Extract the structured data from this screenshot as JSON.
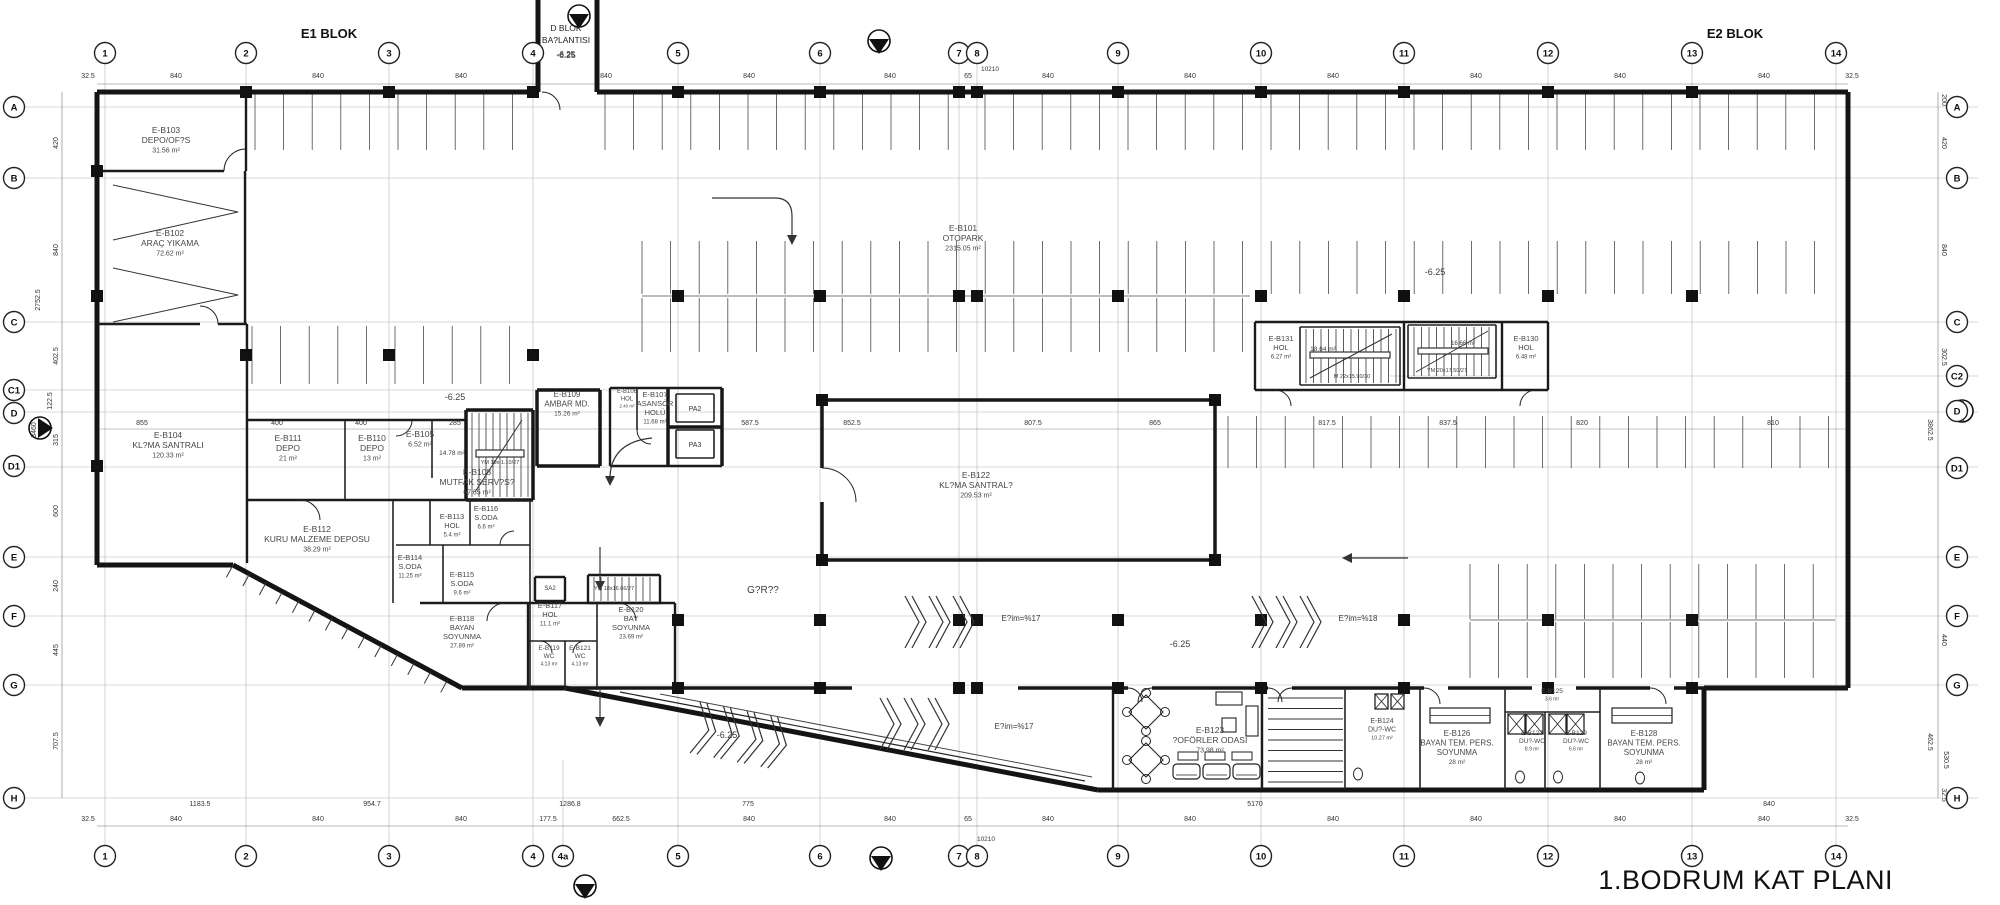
{
  "title": "1.BODRUM KAT PLANI",
  "blocks": {
    "e1": "E1 BLOK",
    "e2": "E2 BLOK",
    "d_line1": "D BLOK",
    "d_line2": "BA?LANTISI",
    "d_level": "-6.25"
  },
  "grid": {
    "cols_top": [
      "1",
      "2",
      "3",
      "4",
      "5",
      "6",
      "7",
      "8",
      "9",
      "10",
      "11",
      "12",
      "13",
      "14"
    ],
    "cols_bottom": [
      "1",
      "2",
      "3",
      "4",
      "4a",
      "5",
      "6",
      "7",
      "8",
      "9",
      "10",
      "11",
      "12",
      "13",
      "14"
    ],
    "rows_left": [
      "A",
      "B",
      "C",
      "C1",
      "D",
      "D1",
      "E",
      "F",
      "G",
      "H"
    ],
    "rows_right": [
      "A",
      "B",
      "C",
      "C2",
      "D",
      "D1",
      "E",
      "F",
      "G",
      "H"
    ]
  },
  "dims": {
    "top": [
      "32.5",
      "840",
      "840",
      "840",
      "840",
      "840",
      "840",
      "65",
      "840",
      "840",
      "840",
      "840",
      "840",
      "840",
      "32.5"
    ],
    "top_total": "10210",
    "bottom_lower": [
      "32.5",
      "840",
      "840",
      "840",
      "177.5",
      "662.5",
      "840",
      "840",
      "65",
      "840",
      "840",
      "840",
      "840",
      "840",
      "840",
      "32.5"
    ],
    "bottom_upper": [
      "1183.5",
      "954.7",
      "1286.8",
      "775",
      "5170",
      "840"
    ],
    "bottom_total": "10210",
    "left": [
      "420",
      "840",
      "2752.5",
      "402.5",
      "122.5",
      "315",
      "3460",
      "600",
      "240",
      "445",
      "707.5"
    ],
    "right": [
      "200",
      "420",
      "840",
      "302.5",
      "3862.5",
      "440",
      "462.5",
      "530.5",
      "32.5"
    ],
    "mid_row": [
      "855",
      "400",
      "400",
      "285",
      "587.5",
      "852.5",
      "807.5",
      "865",
      "817.5",
      "837.5",
      "820",
      "810"
    ]
  },
  "elevators": {
    "pa2": "PA2",
    "pa3": "PA3",
    "sa2": "SA2"
  },
  "rooms": [
    {
      "id": "E-B103",
      "name": "DEPO/OF?S",
      "area": "31.56 m²"
    },
    {
      "id": "E-B102",
      "name": "ARAÇ YIKAMA",
      "area": "72.62 m²"
    },
    {
      "id": "E-B101",
      "name": "OTOPARK",
      "area": "2315.05 m²"
    },
    {
      "id": "E-B104",
      "name": "KL?MA SANTRALI",
      "area": "120.33 m²"
    },
    {
      "id": "E-B111",
      "name": "DEPO",
      "area": "21 m²"
    },
    {
      "id": "E-B110",
      "name": "DEPO",
      "area": "13 m²"
    },
    {
      "id": "E-B105",
      "name": "",
      "area": "6.52 m²"
    },
    {
      "id": "E-B106",
      "name": "HOL",
      "area": "2.40 m²"
    },
    {
      "id": "E-B107",
      "name": "ASANSÖR",
      "name2": "HOLÜ",
      "area": "11.68 m²"
    },
    {
      "id": "E-B109",
      "name": "AMBAR MD.",
      "area": "15.26 m²"
    },
    {
      "id": "E-B108",
      "name": "MUTFAK SERV?S?",
      "area": "67.65 m²"
    },
    {
      "id": "E-B112",
      "name": "KURU MALZEME DEPOSU",
      "area": "38.29 m²"
    },
    {
      "id": "E-B113",
      "name": "HOL",
      "area": "5.4 m²"
    },
    {
      "id": "E-B116",
      "name": "S.ODA",
      "area": "6.6 m²"
    },
    {
      "id": "E-B114",
      "name": "S.ODA",
      "area": "11.25 m²"
    },
    {
      "id": "E-B115",
      "name": "S.ODA",
      "area": "9.6 m²"
    },
    {
      "id": "E-B117",
      "name": "HOL",
      "area": "11.1 m²"
    },
    {
      "id": "E-B118",
      "name": "BAYAN",
      "name2": "SOYUNMA",
      "area": "27.89 m²"
    },
    {
      "id": "E-B119",
      "name": "WC",
      "area": "4.13 m²"
    },
    {
      "id": "E-B121",
      "name": "WC",
      "area": "4.13 m²"
    },
    {
      "id": "E-B120",
      "name": "BAY",
      "name2": "SOYUNMA",
      "area": "23.69 m²"
    },
    {
      "id": "E-B122",
      "name": "KL?MA SANTRAL?",
      "area": "209.53 m²"
    },
    {
      "id": "E-B131",
      "name": "HOL",
      "area": "6.27 m²"
    },
    {
      "id": "E-B130",
      "name": "HOL",
      "area": "6.48 m²"
    },
    {
      "id": "E-B123",
      "name": "?OFÖRLER ODASI",
      "area": "73.98 m²"
    },
    {
      "id": "E-B124",
      "name": "DU?-WC",
      "area": "10.27 m²"
    },
    {
      "id": "E-B126",
      "name": "BAYAN TEM. PERS.",
      "name2": "SOYUNMA",
      "area": "28 m²"
    },
    {
      "id": "E-B125",
      "name": "",
      "area": "3.6 m²"
    },
    {
      "id": "E-B127",
      "name": "DU?-WC",
      "area": "8.9 m²"
    },
    {
      "id": "E-B129",
      "name": "DU?-WC",
      "area": "6.6 m²"
    },
    {
      "id": "E-B128",
      "name": "BAYAN TEM. PERS.",
      "name2": "SOYUNMA",
      "area": "28 m²"
    }
  ],
  "annotations": [
    "-6.25",
    "-6.25",
    "-6.25",
    "-6.25",
    "-6.25",
    "G?R??",
    "E?im=%17",
    "E?im=%18",
    "E?im=%17",
    "YM 19x 1.10/27",
    "14.78 m²",
    "18.64 m²",
    "M 22x15.90/30",
    "16.66 m²",
    "YM 20x17.50/27",
    "YM 18x16.66/27"
  ]
}
